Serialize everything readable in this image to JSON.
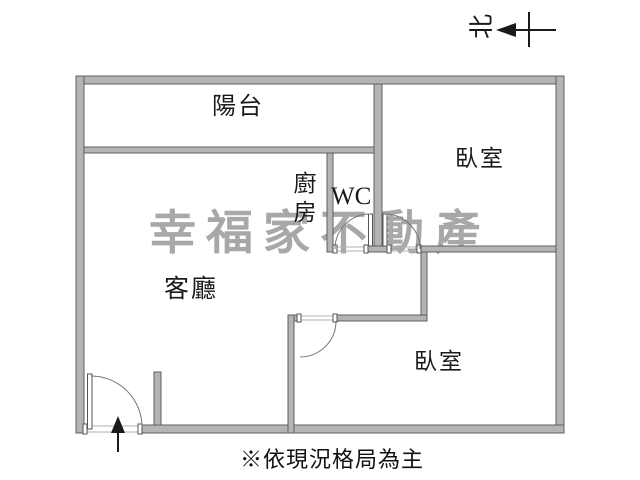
{
  "floorplan": {
    "north_label": "北",
    "rooms": {
      "balcony": "陽台",
      "kitchen": "廚房",
      "wc": "WC",
      "bedroom_top_right": "臥室",
      "living_room": "客廳",
      "bedroom_bottom": "臥室"
    },
    "watermark": "幸福家不動產",
    "caption": "※依現況格局為主",
    "colors": {
      "wall_fill": "#b4b4b4",
      "wall_edge": "#5f5f5f",
      "door_arc": "#777777",
      "watermark": "#a8a8a8",
      "ink": "#1a1a1a"
    }
  }
}
